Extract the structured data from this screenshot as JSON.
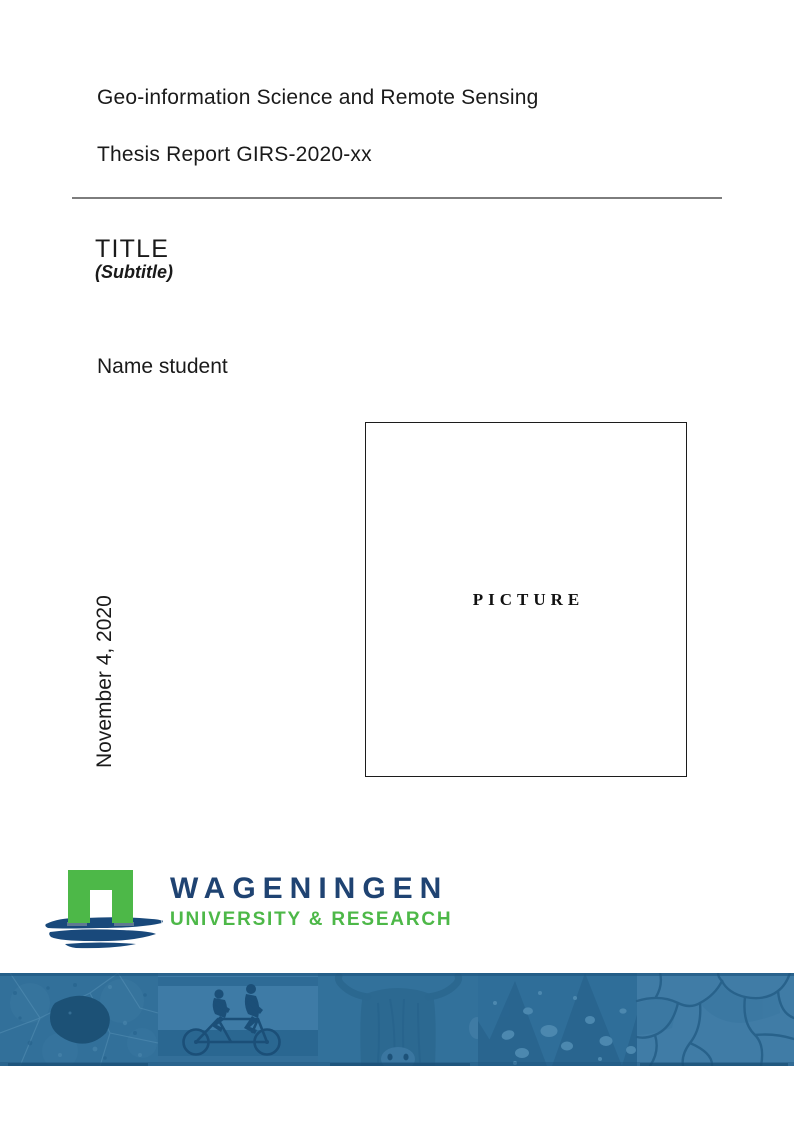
{
  "document": {
    "program": "Geo-information Science and Remote Sensing",
    "report_number": "Thesis Report GIRS-2020-xx",
    "title": "TITLE",
    "subtitle": "(Subtitle)",
    "author": "Name student",
    "date": "November 4, 2020",
    "picture_placeholder": "PICTURE"
  },
  "logo": {
    "wordmark": "WAGENINGEN",
    "tagline": "UNIVERSITY & RESEARCH",
    "colors": {
      "green": "#4db848",
      "navy": "#1f4372",
      "brush_blue": "#19497b"
    }
  },
  "banner": {
    "overlay_color": "#33719b",
    "photos": [
      {
        "name": "aerial-parcels"
      },
      {
        "name": "tandem-cyclists"
      },
      {
        "name": "highland-cow"
      },
      {
        "name": "leaf-water-droplets"
      },
      {
        "name": "cracked-earth"
      }
    ]
  }
}
